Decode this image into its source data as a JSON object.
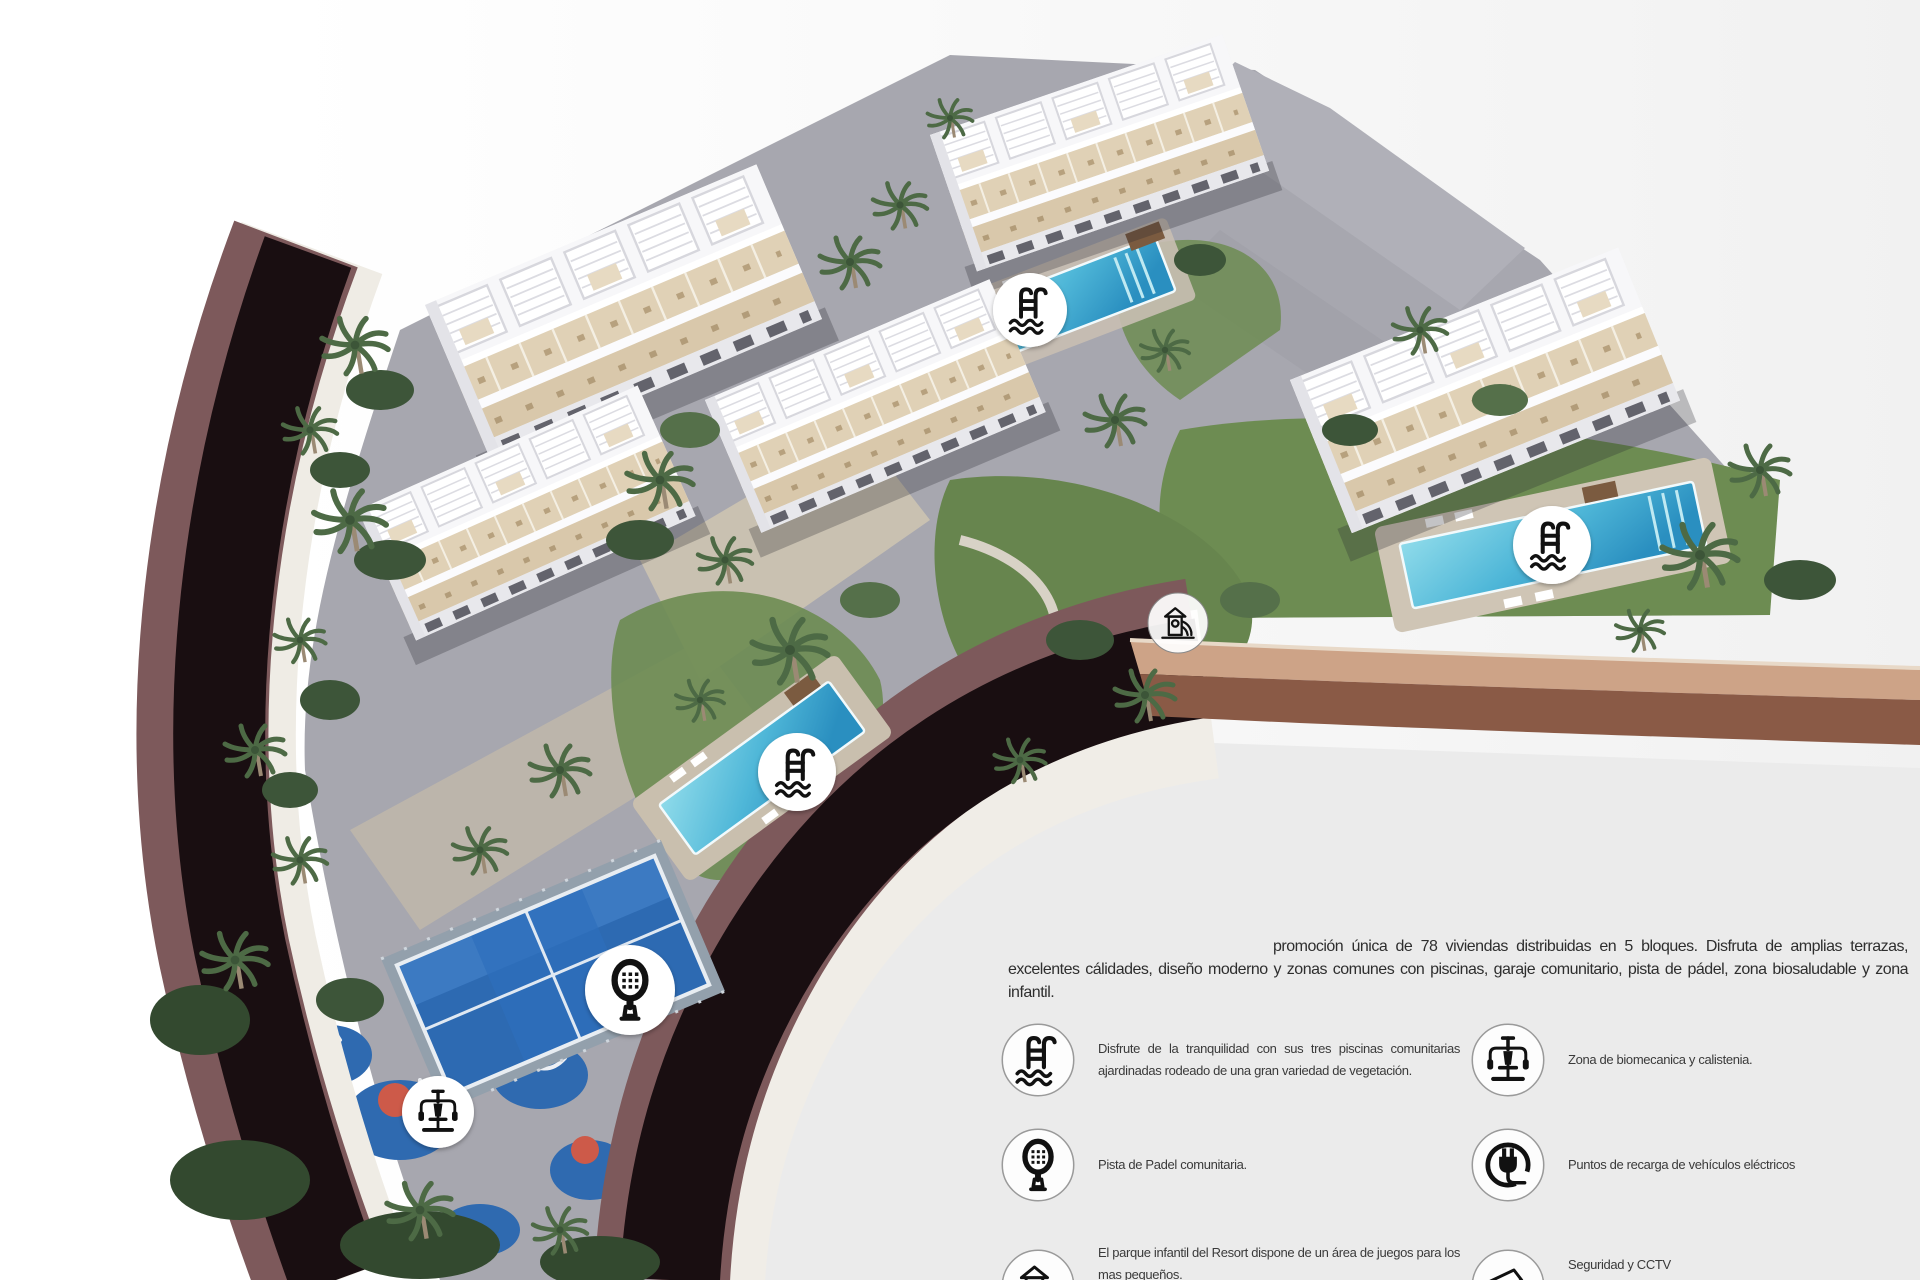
{
  "promo": {
    "paragraph": "promoción única de 78 viviendas distribuidas en 5 bloques. Disfruta de amplias terrazas, excelentes cálidades, diseño moderno y zonas comunes con piscinas, garaje comunitario, pista de pádel, zona biosaludable y zona infantil."
  },
  "legend": {
    "left": [
      {
        "icon": "pool-icon",
        "text": "Disfrute de la tranquilidad con sus tres piscinas comunitarias ajardinadas rodeado de una gran variedad de vegetación."
      },
      {
        "icon": "padel-icon",
        "text": "Pista de Padel comunitaria."
      },
      {
        "icon": "playground-icon",
        "text": "El parque infantil del Resort dispone de un área de juegos para los mas pequeños."
      }
    ],
    "right": [
      {
        "icon": "gym-icon",
        "text": "Zona de biomecanica y calistenia."
      },
      {
        "icon": "plug-icon",
        "text": "Puntos de recarga de vehículos eléctricos"
      },
      {
        "icon": "cctv-icon",
        "text": "Seguridad y CCTV"
      }
    ]
  },
  "map_badges": [
    {
      "icon": "pool-icon"
    },
    {
      "icon": "pool-icon"
    },
    {
      "icon": "pool-icon"
    },
    {
      "icon": "playground-icon"
    },
    {
      "icon": "padel-icon"
    },
    {
      "icon": "gym-icon"
    }
  ],
  "colors": {
    "pool_water": "#4fb7d8",
    "padel_court": "#2d6ab2",
    "road_dark": "#190e11",
    "road_border_maroon": "#7d595b",
    "grass": "#6d8c52",
    "building_white": "#f4f4f6",
    "terrace_tan": "#ddccae",
    "background_gray": "#ebebeb",
    "wall_tan": "#cda387",
    "icon_black": "#111111",
    "badge_bg": "#ffffff"
  }
}
